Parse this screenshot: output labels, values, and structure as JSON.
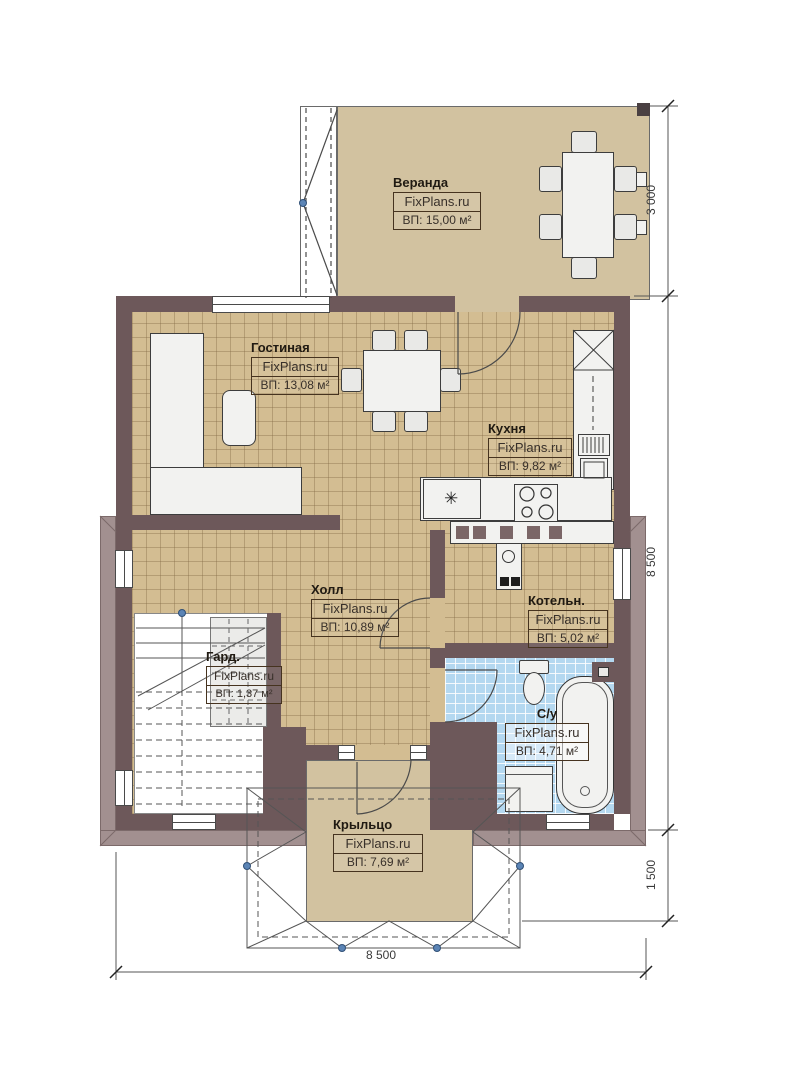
{
  "watermark": "FixPlans.ru",
  "rooms": {
    "veranda": {
      "name": "Веранда",
      "area": "ВП: 15,00 м²"
    },
    "living": {
      "name": "Гостиная",
      "area": "ВП: 13,08 м²"
    },
    "kitchen": {
      "name": "Кухня",
      "area": "ВП: 9,82 м²"
    },
    "hall": {
      "name": "Холл",
      "area": "ВП: 10,89 м²"
    },
    "boiler": {
      "name": "Котельн.",
      "area": "ВП: 5,02 м²"
    },
    "wardrobe": {
      "name": "Гард.",
      "area": "ВП: 1,37 м²"
    },
    "bathroom": {
      "name": "С/у",
      "area": "ВП: 4,71 м²"
    },
    "porch": {
      "name": "Крыльцо",
      "area": "ВП: 7,69 м²"
    }
  },
  "dimensions": {
    "right_top": "3 000",
    "right_middle": "8 500",
    "right_bottom": "1 500",
    "bottom": "8 500"
  },
  "symbols": {
    "snowflake": "✳"
  },
  "colors": {
    "wall": "#6d585a",
    "floor_tan": "#d3bd92",
    "veranda_tan": "#d2c2a0",
    "tile_blue": "#b4d8f0",
    "eaves": "#a29090",
    "marker_blue": "#5b84b5"
  }
}
